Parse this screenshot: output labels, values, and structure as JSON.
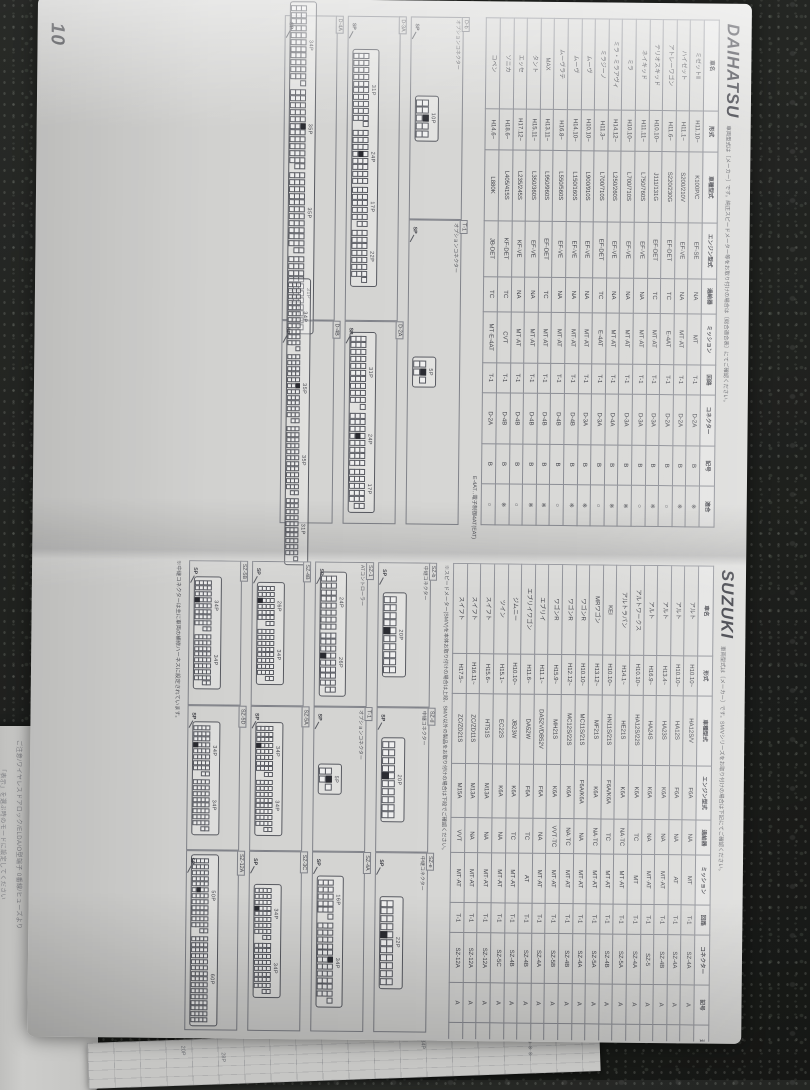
{
  "page_number": "10",
  "colors": {
    "paper": "#dadad8",
    "ink": "#43444b",
    "line": "#8d8f96",
    "granite": "#1d1f1c"
  },
  "table_columns": [
    "車名",
    "形式",
    "車種型式",
    "エンジン型式",
    "過給器",
    "ミッション",
    "回路",
    "コネクター",
    "記号",
    "適合"
  ],
  "daihatsu": {
    "title": "DAIHATSU",
    "note": "車両型式は〔メーカー〕です。純正スピードメーター等をお取り付けの場合は〔総合適合表〕にてご確認ください。",
    "footnote": "E-4AT‥電子制御4AT(EAT)",
    "table_rows": [
      [
        "ミゼットⅡ",
        "H11.10~",
        "K100P/C",
        "EF-SE",
        "NA",
        "MT",
        "T-1",
        "D-2A",
        "B",
        "※"
      ],
      [
        "ハイゼット",
        "H11.1~",
        "S200/210V",
        "EF-VE",
        "NA",
        "MT·AT",
        "T-1",
        "D-2A",
        "B",
        "※"
      ],
      [
        "アトレーワゴン",
        "H11.6~",
        "S220/230G",
        "EF-DET",
        "TC",
        "E-4AT",
        "T-1",
        "D-2A",
        "B",
        "○"
      ],
      [
        "テリオスキッド",
        "H10.10~",
        "J111/131G",
        "EF-DET",
        "TC",
        "MT·AT",
        "T-1",
        "D-3A",
        "B",
        "※"
      ],
      [
        "ネイキッド",
        "H11.11~",
        "L750/760S",
        "EF-VE",
        "NA",
        "MT·AT",
        "T-1",
        "D-3A",
        "B",
        "○"
      ],
      [
        "ミラ",
        "H10.10~",
        "L700/710S",
        "EF-VE",
        "NA",
        "MT·AT",
        "T-1",
        "D-3A",
        "B",
        "※"
      ],
      [
        "ミラ・ミラアヴィ",
        "H14.12~",
        "L250/260S",
        "EF-VE",
        "NA",
        "MT·AT",
        "T-1",
        "D-4A",
        "B",
        "※"
      ],
      [
        "ミラジーノ",
        "H11.3~",
        "L700/710S",
        "EF-DET",
        "TC",
        "E-4AT",
        "T-1",
        "D-3A",
        "B",
        "○"
      ],
      [
        "ムーヴ",
        "H10.10~",
        "L900/910S",
        "EF-VE",
        "NA",
        "MT·AT",
        "T-1",
        "D-3A",
        "B",
        "※"
      ],
      [
        "ムーヴ",
        "H14.10~",
        "L150/160S",
        "EF-VE",
        "NA",
        "MT·AT",
        "T-1",
        "D-4B",
        "B",
        "※"
      ],
      [
        "ムーヴラテ",
        "H16.8~",
        "L550/560S",
        "EF-VE",
        "NA",
        "MT·AT",
        "T-1",
        "D-4B",
        "B",
        "○"
      ],
      [
        "MAX",
        "H13.11~",
        "L950/960S",
        "EF-DET",
        "TC",
        "MT·AT",
        "T-1",
        "D-4B",
        "B",
        "※"
      ],
      [
        "タント",
        "H15.11~",
        "L350/360S",
        "EF-VE",
        "NA",
        "MT·AT",
        "T-1",
        "D-4B",
        "B",
        "※"
      ],
      [
        "エッセ",
        "H17.12~",
        "L235/245S",
        "KF-VE",
        "NA",
        "MT·AT",
        "T-1",
        "D-4B",
        "B",
        "○"
      ],
      [
        "ソニカ",
        "H18.6~",
        "L405/415S",
        "KF-DET",
        "TC",
        "CVT",
        "T-1",
        "D-4B",
        "B",
        "※"
      ],
      [
        "コペン",
        "H14.6~",
        "L880K",
        "JB-DET",
        "TC",
        "MT·E-4AT",
        "T-1",
        "D-2A",
        "B",
        "○"
      ]
    ],
    "diagrams": [
      {
        "id": "D-b",
        "sub": "オプションコネクター",
        "span": 4,
        "pin": 5,
        "rows": 2,
        "segs": [
          {
            "label": "10P",
            "pins": 10,
            "sp": true
          }
        ]
      },
      {
        "id": "T-1",
        "sub": "オプションコネクター",
        "span": 6,
        "pin": 5,
        "rows": 2,
        "segs": [
          {
            "label": "5P",
            "pins": 5,
            "sp": true
          }
        ]
      },
      {
        "id": "D-3A",
        "sub": "",
        "span": 6,
        "pin": 4,
        "rows": 3,
        "segs": [
          {
            "label": "31P",
            "pins": 31
          },
          {
            "label": "24P",
            "pins": 24,
            "sp": true
          },
          {
            "label": "17P",
            "pins": 17
          },
          {
            "label": "22P",
            "pins": 22
          }
        ]
      },
      {
        "id": "D-2A",
        "sub": "",
        "span": 4,
        "pin": 4,
        "rows": 3,
        "segs": [
          {
            "label": "31P",
            "pins": 31
          },
          {
            "label": "24P",
            "pins": 24,
            "sp": true
          },
          {
            "label": "17P",
            "pins": 17
          }
        ]
      },
      {
        "id": "D-4A",
        "sub": "",
        "span": 6,
        "pin": 4,
        "rows": 3,
        "segs": [
          {
            "label": "34P",
            "pins": 34
          },
          {
            "label": "35P",
            "pins": 35,
            "sp": true
          },
          {
            "label": "35P",
            "pins": 35
          },
          {
            "label": "31P",
            "pins": 31
          }
        ]
      },
      {
        "id": "D-4B",
        "sub": "",
        "span": 4,
        "pin": 3,
        "rows": 3,
        "segs": [
          {
            "label": "34P",
            "pins": 34
          },
          {
            "label": "35P",
            "pins": 35,
            "sp": true
          },
          {
            "label": "35P",
            "pins": 35
          },
          {
            "label": "31P",
            "pins": 31
          }
        ]
      }
    ]
  },
  "suzuki": {
    "title": "SUZUKI",
    "note": "車両型式は〔メーカー〕です。SM/Vシリーズをお取り付けの場合は下記にてご確認ください。",
    "mid_note": "※スピードメーター(SM/V)を本体お取り付けの場合は上段、SM/V以外の製品をお取り付けの場合は下段でご確認ください。",
    "diagram_footnote": "※中継コネクターは主に車両の補修ハーネスに設定されています。",
    "table_rows": [
      [
        "アルト",
        "H10.10~",
        "HA12S/V",
        "F6A",
        "NA",
        "MT",
        "T-1",
        "SZ-4A",
        "A",
        "※"
      ],
      [
        "アルト",
        "H10.10~",
        "HA12S",
        "F6A",
        "NA",
        "AT",
        "T-1",
        "SZ-4A",
        "A",
        "※"
      ],
      [
        "アルト",
        "H13.4~",
        "HA23S",
        "K6A",
        "NA",
        "MT·AT",
        "T-1",
        "SZ-4B",
        "A",
        "※"
      ],
      [
        "アルト",
        "H16.9~",
        "HA24S",
        "K6A",
        "NA",
        "MT·AT",
        "T-1",
        "SZ-5",
        "A",
        "○"
      ],
      [
        "アルトワークス",
        "H10.10~",
        "HA12S/22S",
        "K6A",
        "TC",
        "MT",
        "T-1",
        "SZ-4A",
        "A",
        "※"
      ],
      [
        "アルトラパン",
        "H14.1~",
        "HE21S",
        "K6A",
        "NA·TC",
        "MT·AT",
        "T-1",
        "SZ-5A",
        "A",
        "○"
      ],
      [
        "KEI",
        "H10.10~",
        "HN11S/21S",
        "F6A/K6A",
        "TC",
        "MT·AT",
        "T-1",
        "SZ-4B",
        "A",
        "※"
      ],
      [
        "MRワゴン",
        "H13.12~",
        "MF21S",
        "K6A",
        "NA·TC",
        "MT·AT",
        "T-1",
        "SZ-5A",
        "A",
        "○"
      ],
      [
        "ワゴンR",
        "H10.10~",
        "MC11S/21S",
        "F6A/K6A",
        "NA",
        "MT·AT",
        "T-1",
        "SZ-4A",
        "A",
        "※"
      ],
      [
        "ワゴンR",
        "H12.12~",
        "MC12S/22S",
        "K6A",
        "NA·TC",
        "MT·AT",
        "T-1",
        "SZ-4B",
        "A",
        "※"
      ],
      [
        "ワゴンR",
        "H15.9~",
        "MH21S",
        "K6A",
        "VVT·TC",
        "MT·AT",
        "T-1",
        "SZ-5B",
        "A",
        "○"
      ],
      [
        "エブリイ",
        "H11.1~",
        "DA52V/DB52V",
        "F6A",
        "NA",
        "MT·AT",
        "T-1",
        "SZ-4A",
        "A",
        "※"
      ],
      [
        "エブリイワゴン",
        "H11.6~",
        "DA52W",
        "F6A",
        "TC",
        "AT",
        "T-1",
        "SZ-4B",
        "A",
        "○"
      ],
      [
        "ジムニー",
        "H10.10~",
        "JB23W",
        "K6A",
        "TC",
        "MT·AT",
        "T-1",
        "SZ-4B",
        "A",
        "※"
      ],
      [
        "ツイン",
        "H15.1~",
        "EC22S",
        "K6A",
        "NA",
        "MT·AT",
        "T-1",
        "SZ-5C",
        "A",
        "○"
      ],
      [
        "スイフト",
        "H15.6~",
        "HT51S",
        "M13A",
        "NA",
        "MT·AT",
        "T-1",
        "SZ-12A",
        "A",
        "※"
      ],
      [
        "スイフト",
        "H16.11~",
        "ZC/ZD11S",
        "M13A",
        "NA",
        "MT·AT",
        "T-1",
        "SZ-12A",
        "A",
        "○"
      ],
      [
        "スイフト",
        "H17.5~",
        "ZC/ZD21S",
        "M15A",
        "VVT",
        "MT·AT",
        "T-1",
        "SZ-12A",
        "A",
        "※"
      ]
    ],
    "diagrams": [
      {
        "id": "SZ-b",
        "sub": "中継コネクター",
        "span": 1,
        "pin": 5,
        "rows": 2,
        "segs": [
          {
            "label": "20P",
            "pins": 20,
            "sp": true
          }
        ]
      },
      {
        "id": "SZ-d",
        "sub": "中継コネクター",
        "span": 1,
        "pin": 5,
        "rows": 2,
        "segs": [
          {
            "label": "20P",
            "pins": 20,
            "sp": true
          }
        ]
      },
      {
        "id": "SZ-e",
        "sub": "中継コネクター",
        "span": 1,
        "pin": 5,
        "rows": 2,
        "segs": [
          {
            "label": "22P",
            "pins": 22,
            "sp": true
          }
        ]
      },
      {
        "id": "SZ-1",
        "sub": "ATコントローラー",
        "span": 1,
        "pin": 4,
        "rows": 3,
        "segs": [
          {
            "label": "24P",
            "pins": 24
          },
          {
            "label": "26P",
            "pins": 26,
            "sp": true
          }
        ]
      },
      {
        "id": "T-1",
        "sub": "オプションコネクター",
        "span": 1,
        "pin": 5,
        "rows": 2,
        "segs": [
          {
            "label": "5P",
            "pins": 5,
            "sp": true
          }
        ]
      },
      {
        "id": "SZ-4A",
        "sub": "",
        "span": 1,
        "pin": 4,
        "rows": 3,
        "segs": [
          {
            "label": "16P",
            "pins": 16
          },
          {
            "label": "34P",
            "pins": 34,
            "sp": true
          }
        ]
      },
      {
        "id": "SZ-4B",
        "sub": "",
        "span": 1,
        "pin": 3,
        "rows": 4,
        "segs": [
          {
            "label": "26P",
            "pins": 26,
            "sp": true
          },
          {
            "label": "34P",
            "pins": 34
          }
        ]
      },
      {
        "id": "SZ-5A",
        "sub": "",
        "span": 1,
        "pin": 3,
        "rows": 4,
        "segs": [
          {
            "label": "34P",
            "pins": 34,
            "sp": true
          },
          {
            "label": "34P",
            "pins": 34
          }
        ]
      },
      {
        "id": "SZ-3C",
        "sub": "",
        "span": 1,
        "pin": 3,
        "rows": 4,
        "segs": [
          {
            "label": "34P",
            "pins": 34,
            "sp": true
          },
          {
            "label": "34P",
            "pins": 34
          }
        ]
      },
      {
        "id": "SZ-5B",
        "sub": "",
        "span": 1,
        "pin": 3,
        "rows": 4,
        "segs": [
          {
            "label": "34P",
            "pins": 34,
            "sp": true
          },
          {
            "label": "34P",
            "pins": 34
          }
        ]
      },
      {
        "id": "SZ-5D",
        "sub": "",
        "span": 1,
        "pin": 3,
        "rows": 4,
        "segs": [
          {
            "label": "34P",
            "pins": 34,
            "sp": true
          },
          {
            "label": "34P",
            "pins": 34
          }
        ]
      },
      {
        "id": "SZ-12A",
        "sub": "",
        "span": 1,
        "pin": 3,
        "rows": 4,
        "segs": [
          {
            "label": "50P",
            "pins": 50,
            "sp": true
          },
          {
            "label": "60P",
            "pins": 60
          }
        ]
      }
    ]
  },
  "under_sheet": {
    "lines": [
      "ご注意/ワイヤレスドアロック/ELDA/O型端子 0番線/ヒューズより",
      "「表示」を選ぶ時のモードに設定してください"
    ]
  },
  "bottom_strip": {
    "fragments": [
      "20P",
      "28P",
      "34P",
      "※ ※ ※ ※"
    ]
  }
}
